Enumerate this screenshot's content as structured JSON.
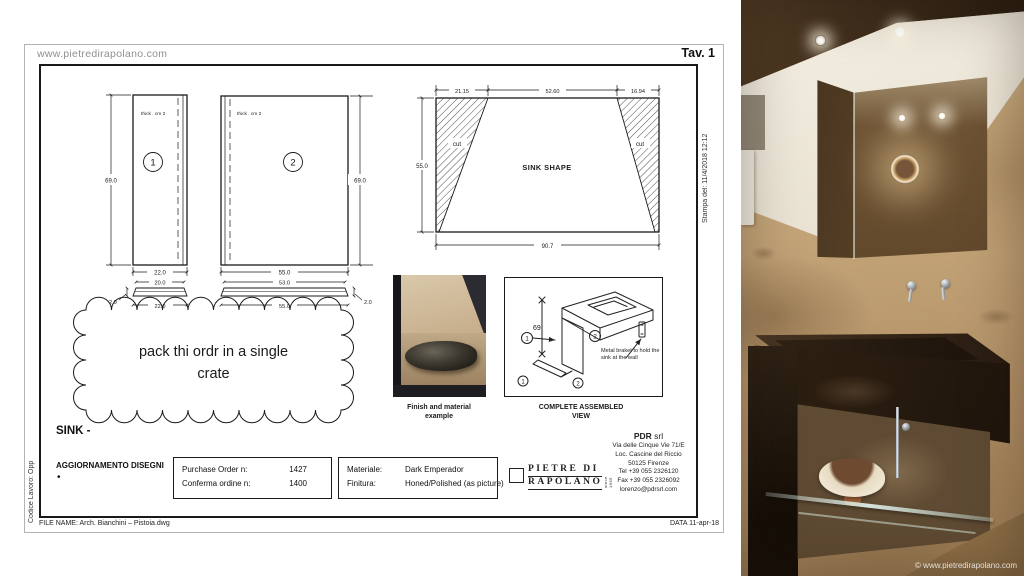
{
  "sheet": {
    "website": "www.pietredirapolano.com",
    "tav": "Tav. 1",
    "stampa_del": "Stampa del: 11/4/2018 12:12",
    "codice_lavoro": "Codice Lavoro: Opp",
    "file_name": "FILE NAME: Arch. Bianchini – Pistoia.dwg",
    "data_label": "DATA 11-apr-18",
    "title": "SINK -",
    "aggiornamento": "AGGIORNAMENTO DISEGNI",
    "bullet": "•"
  },
  "drawings": {
    "piece1": {
      "num": "1",
      "thickness_note": "thick . cm 2",
      "height": "69.0",
      "width": "22.0",
      "strip_top": "20.0",
      "strip_bottom": "22.0",
      "strip_thickness": "2.0"
    },
    "piece2": {
      "num": "2",
      "thickness_note": "thick . cm 2",
      "height": "69.0",
      "width": "55.0",
      "strip_top": "53.0",
      "strip_bottom": "55.0",
      "strip_thickness": "2.0"
    },
    "sink_shape": {
      "label": "SINK SHAPE",
      "cut_left": "cut",
      "cut_right": "cut",
      "dim_top_left": "21.15",
      "dim_top_center": "52.60",
      "dim_top_right": "16.94",
      "dim_height": "55.0",
      "dim_width": "90.7"
    },
    "cloud_note": {
      "line1": "pack thi ordr in a single",
      "line2": "crate"
    }
  },
  "finish_example": {
    "caption": "Finish and material example"
  },
  "assembled_view": {
    "caption": "COMPLETE ASSEMBLED VIEW",
    "dim_height": "69",
    "num1": "1",
    "num2": "2",
    "num3": "1",
    "num4": "2",
    "note": "Metal braket to hold the sink at the wall"
  },
  "order_info": {
    "rows": [
      {
        "label": "Purchase Order n:",
        "value": "1427"
      },
      {
        "label": "Conferma ordine n:",
        "value": "1400"
      }
    ]
  },
  "material_info": {
    "rows": [
      {
        "label": "Materiale:",
        "value": "Dark Emperador"
      },
      {
        "label": "Finitura:",
        "value": "Honed/Polished (as picture)"
      }
    ]
  },
  "logo": {
    "line1": "PIETRE DI",
    "line2": "RAPOLANO",
    "tagline": "since 1955"
  },
  "company": {
    "name": "PDR",
    "type": "srl",
    "address": [
      "Via delle Cinque Vie 71/E",
      "Loc. Cascine del Riccio",
      "50125 Firenze",
      "Tel +39 055 2326120",
      "Fax +39 055 2326092",
      "lorenzo@pdrsrl.com"
    ]
  },
  "photo": {
    "watermark": "© www.pietredirapolano.com"
  },
  "colors": {
    "line": "#1a1a1a",
    "muted_text": "#8f8f8f",
    "paper": "#ffffff",
    "marble_beige": "#c3a87e",
    "marble_dark": "#2c2014"
  }
}
